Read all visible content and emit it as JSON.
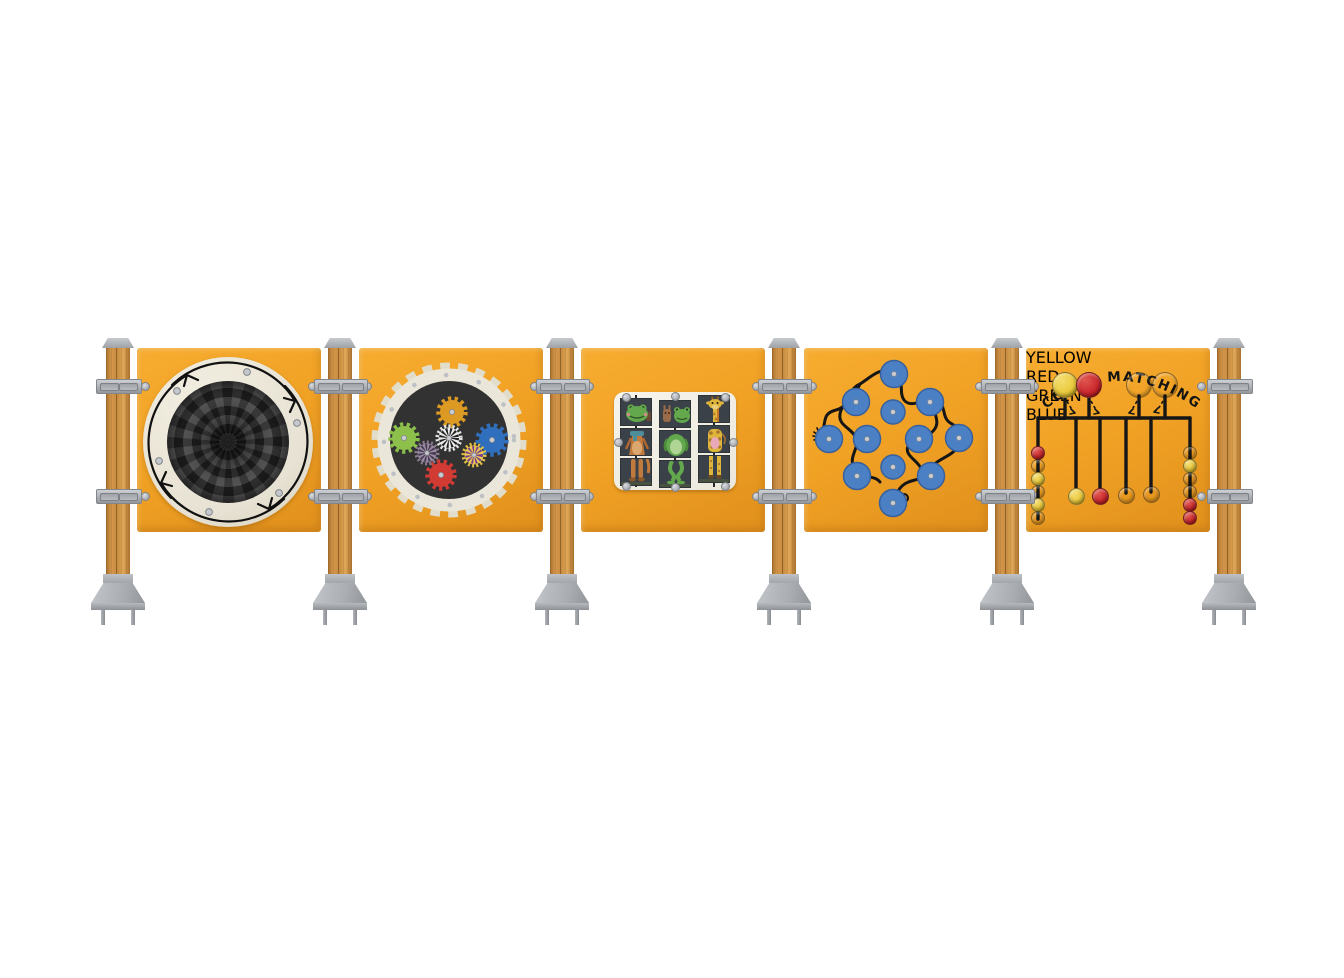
{
  "scene": {
    "description": "Timber-post activity play panel set: five orange panels with tactile games",
    "background": "#FFFFFF",
    "post_count": 6,
    "panel_count": 5
  },
  "colors": {
    "panel_orange": "#F0A124",
    "timber": "#C98C40",
    "metal_gray": "#AEB2B6",
    "cream": "#E7E2D3",
    "dark_disc": "#2C2C2C",
    "line_black": "#161616",
    "maze_blue": "#4B80C4",
    "yellow": "#E9C93A",
    "red": "#C9252B",
    "green": "#20783F",
    "blue": "#2F6FBD"
  },
  "panels": [
    {
      "id": "spinner",
      "name": "optical illusion spinner",
      "arrow_count": 4,
      "ring_bolts": 6
    },
    {
      "id": "gears",
      "name": "gear wall",
      "gear_colors": [
        "orange",
        "green",
        "blue",
        "red",
        "black-white",
        "purple",
        "yellow-purple"
      ]
    },
    {
      "id": "mix-match",
      "name": "animal mix and match slider",
      "columns": 3,
      "rows": 3,
      "animals": [
        "fox",
        "frog",
        "giraffe"
      ]
    },
    {
      "id": "maze",
      "name": "finger wire maze",
      "knob_count": 12
    },
    {
      "id": "color-matching",
      "title": "COLOR MATCHING",
      "top_discs": [
        "yellow",
        "red",
        "green",
        "blue"
      ],
      "sliders": [
        {
          "label": "YELLOW",
          "color": "yellow"
        },
        {
          "label": "RED",
          "color": "red"
        },
        {
          "label": "GREEN",
          "color": "green"
        },
        {
          "label": "BLUE",
          "color": "blue"
        }
      ],
      "left_beads": [
        "red",
        "green",
        "yellow",
        "blue",
        "yellow",
        "blue"
      ],
      "right_beads": [
        "green",
        "yellow",
        "green",
        "blue",
        "red",
        "red"
      ]
    }
  ]
}
